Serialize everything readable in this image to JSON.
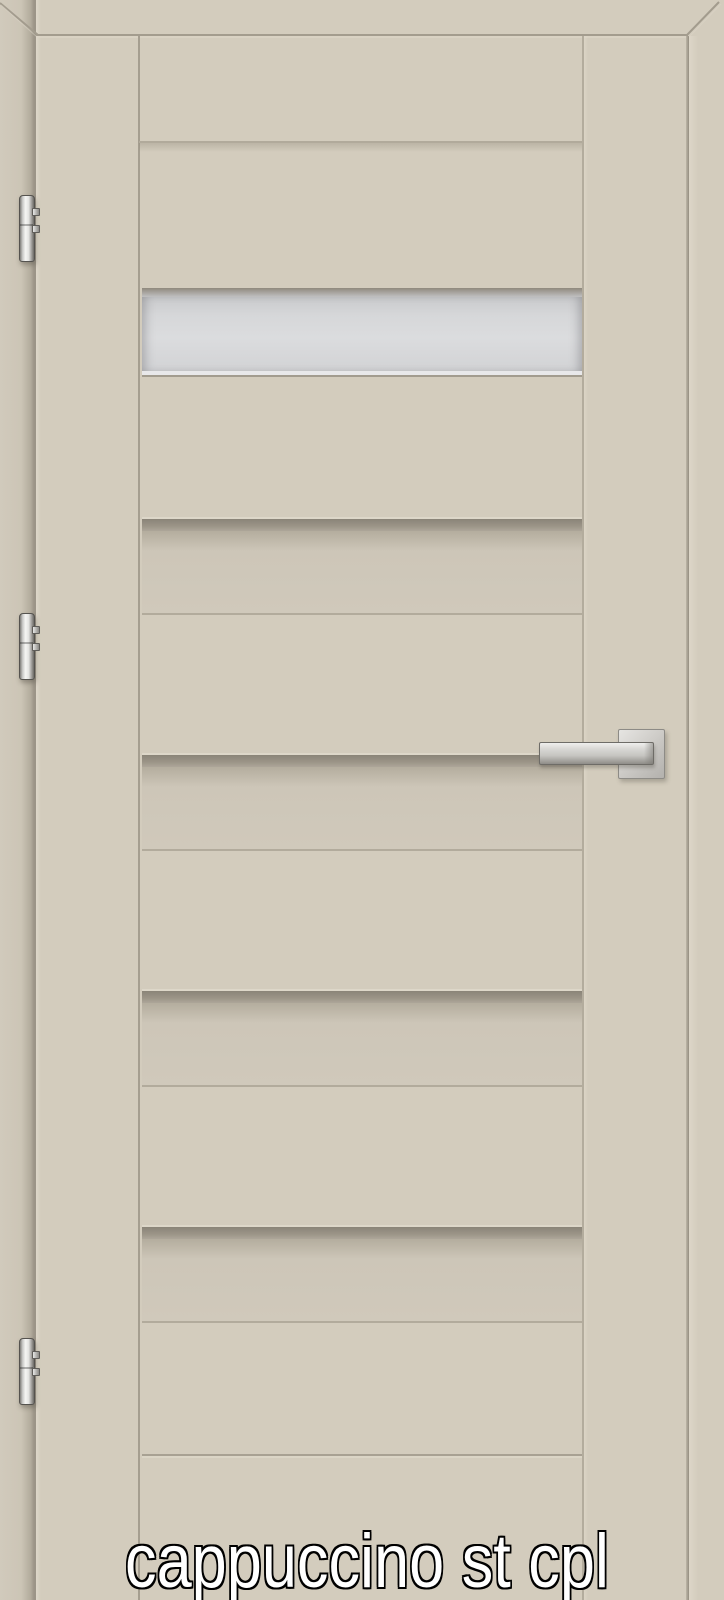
{
  "caption": {
    "text": "cappuccino st cpl",
    "text_color": "#ffffff",
    "outline_color": "#000000"
  },
  "door": {
    "finish_name": "cappuccino",
    "surface_color": "#d3ccbd",
    "groove_shadow_color": "#8a8478",
    "edge_line_color": "#a29b8d",
    "slat_panel_count": 6,
    "recessed_band_count": 4
  },
  "glazing": {
    "glass_color": "#d6d7d9",
    "panel_count": 1
  },
  "hardware": {
    "metal_color": "#d8d8d6",
    "hinge_count": 3,
    "handle_style": "square-rosette-lever"
  }
}
